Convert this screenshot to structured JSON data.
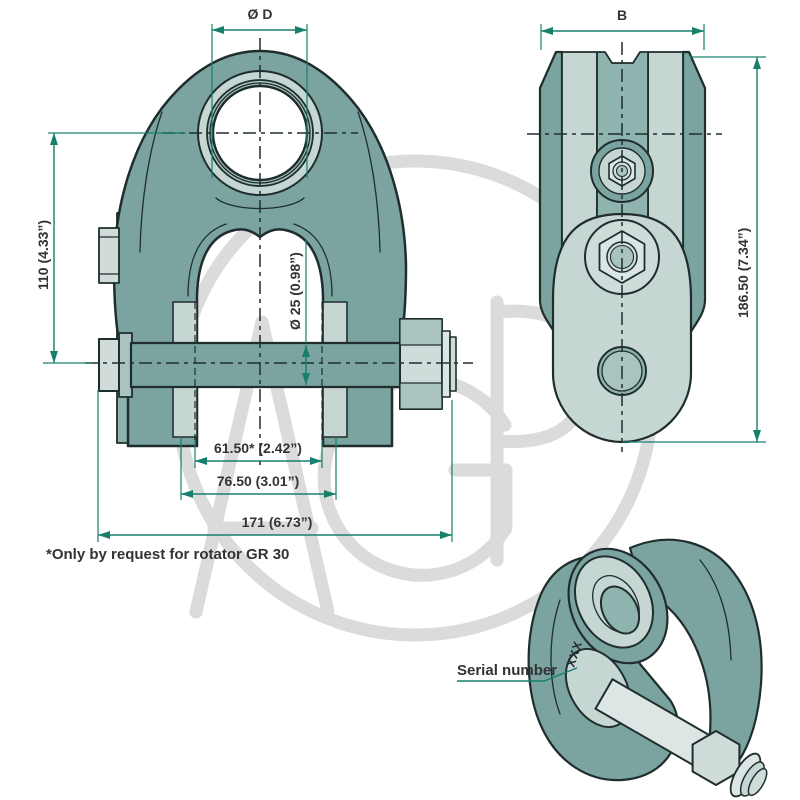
{
  "labels": {
    "dim_hole_diameter": "Ø D",
    "dim_width_b": "B",
    "dim_height_110": "110 (4.33”)",
    "dim_pin_diameter": "Ø 25 (0.98”)",
    "dim_height_186": "186.50 (7.34”)",
    "dim_inner_width_61": "61.50* (2.42”)",
    "dim_bush_width_76": "76.50 (3.01”)",
    "dim_pin_length_171": "171 (6.73”)",
    "footnote": "*Only by request for rotator GR 30",
    "serial_label": "Serial number",
    "serial_marking": "XXX",
    "watermark": "AGP"
  },
  "colors": {
    "ink": "#1F2E2D",
    "teal": "#7BA4A0",
    "mid": "#8FB3AF",
    "pale": "#A9C3C0",
    "light": "#C6D6D3",
    "steel": "#CFDCDA",
    "lighter": "#DCE6E4",
    "accent": "#17806C",
    "text": "#333333",
    "wm": "#DBDBDB"
  }
}
